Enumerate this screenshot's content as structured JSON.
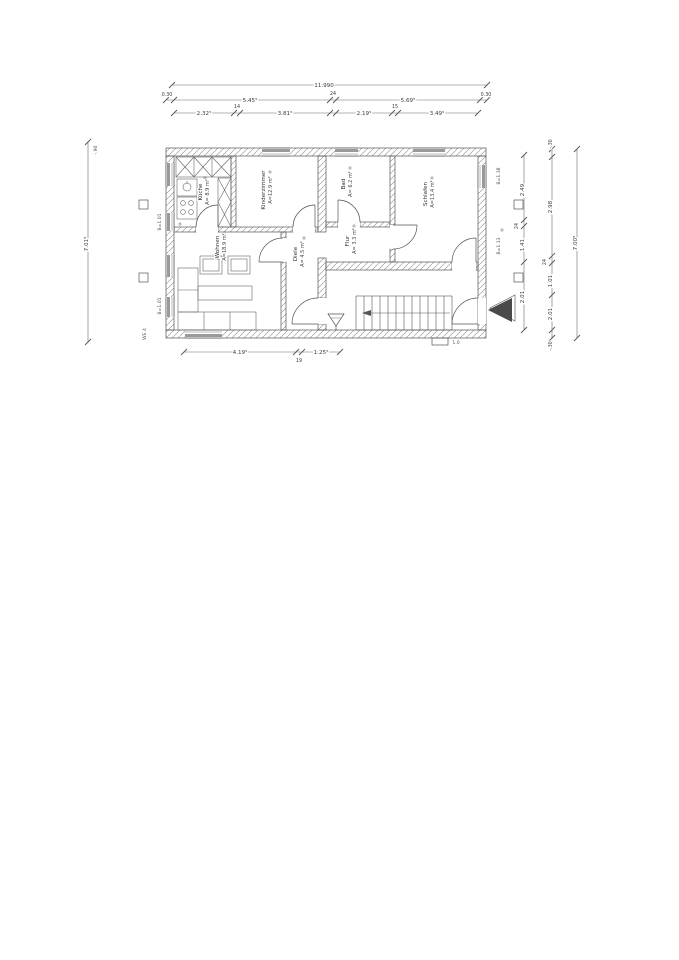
{
  "drawing": {
    "type": "floor-plan",
    "colors": {
      "paper": "#ffffff",
      "ink": "#555555",
      "window_fill": "#9a9a9a",
      "entrance_marker": "#4a4a4a"
    }
  },
  "dims": {
    "top_total": "11.990",
    "top_row2": [
      "0.30",
      "5.45⁵",
      "24",
      "5.69⁵",
      "0.30"
    ],
    "top_row3": [
      "2.32⁵",
      "14",
      "3.81⁵",
      "2.19⁵",
      "15",
      "3.49⁵"
    ],
    "bottom_row": [
      "4.19⁵",
      "19",
      "1.25⁵"
    ],
    "left_total": "7.01⁵",
    "left_top_note": "-.90",
    "right_inner": [
      "2.49",
      "24",
      "1.41",
      "2.01"
    ],
    "right_outer": [
      "-.30",
      "2.98",
      "24",
      "1.01",
      "2.01",
      "-.30"
    ],
    "right_total": "7.00⁵"
  },
  "rooms": {
    "kueche": {
      "name": "Küche",
      "area": "A= 8.9 m²"
    },
    "kinderzimmer": {
      "name": "Kinderzimmer",
      "area": "A=12.9 m²"
    },
    "bad": {
      "name": "Bad",
      "area": "A= 6.2 m²"
    },
    "schlafen": {
      "name": "Schlafen",
      "area": "A=13.4 m²"
    },
    "wohnen": {
      "name": "Wohnen",
      "area": "A=18.9 m²"
    },
    "diele": {
      "name": "Diele",
      "area": "A= 4.5 m²"
    },
    "flur": {
      "name": "Flur",
      "area": "A= 3.3 m²"
    }
  },
  "notes": {
    "corner_label": "WE 4",
    "window_note_left_1": "B=1.01",
    "window_note_left_2": "B=1.01",
    "window_note_right_1": "B=1.38",
    "window_note_right_2": "B=1.13",
    "step_label": "1.0"
  }
}
